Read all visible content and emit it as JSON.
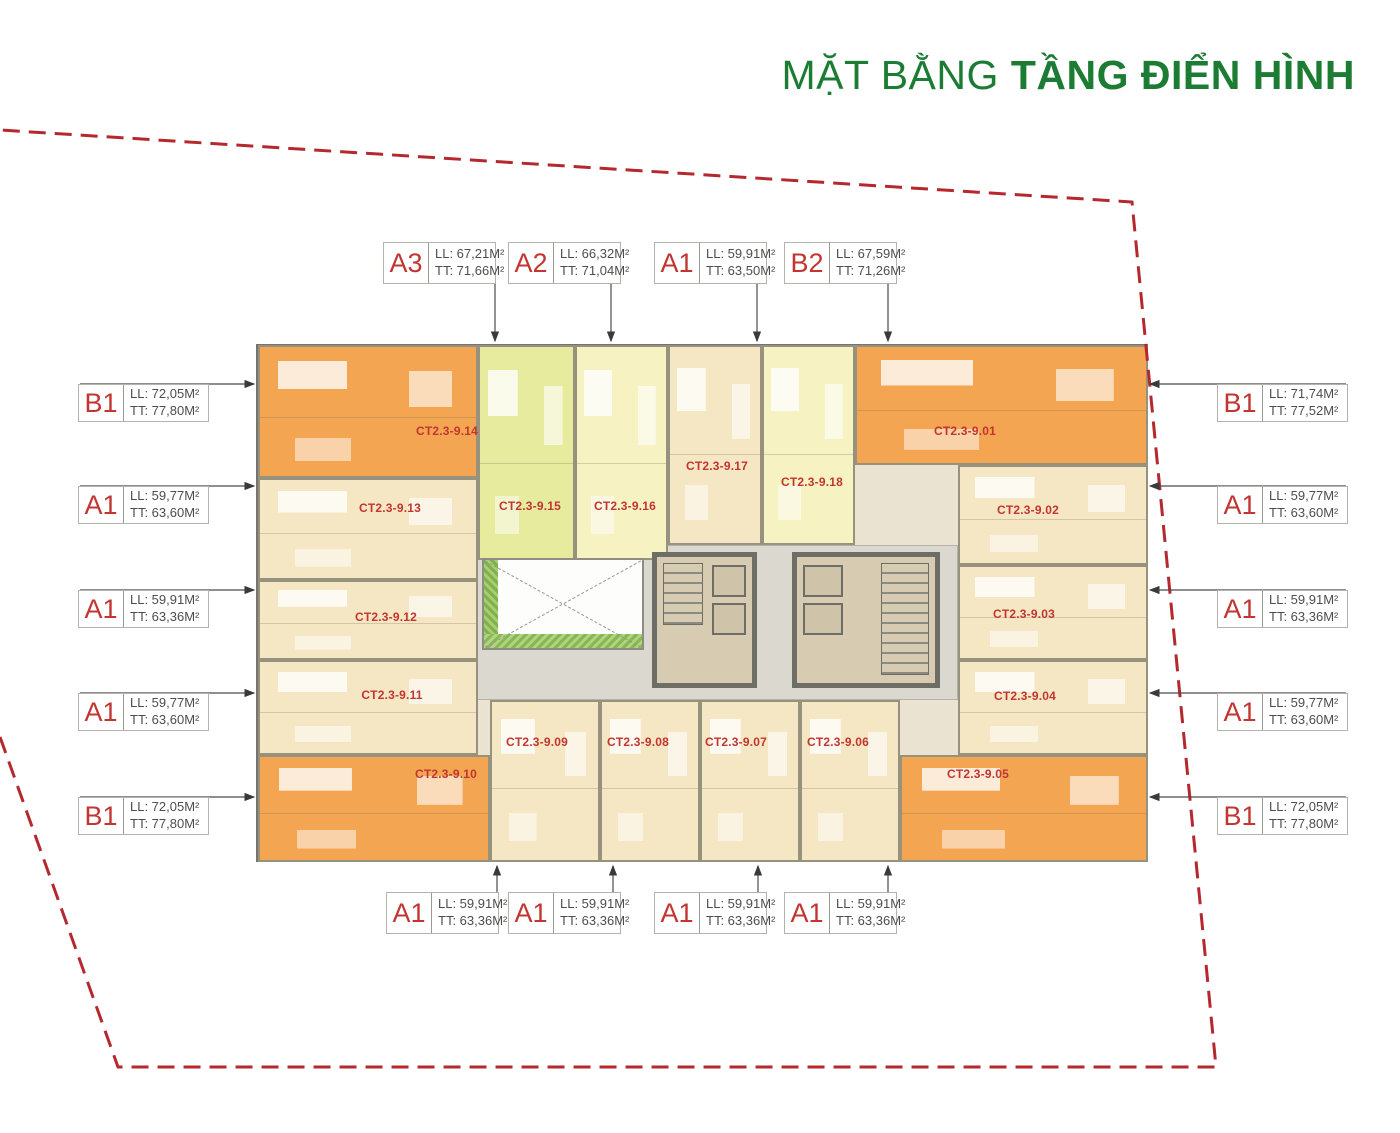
{
  "title": {
    "prefix": "MẶT BẰNG",
    "emphasis": "TẦNG ĐIỂN HÌNH"
  },
  "colors": {
    "title_green": "#1d7c34",
    "label_red": "#c23531",
    "boundary_red": "#b4282e",
    "leader_gray": "#4a4a4a",
    "unit_orange": "#f3a552",
    "unit_cream": "#f6e7c4",
    "unit_yellow_green": "#e6eb9e",
    "unit_pale_yellow": "#f6f2c2",
    "corridor_gray": "#dbd8cf"
  },
  "unit_type_labels": {
    "top": [
      {
        "code": "A3",
        "line1": "LL: 67,21M²",
        "line2": "TT: 71,66M²",
        "x": 383,
        "y": 242,
        "leader_x": 495
      },
      {
        "code": "A2",
        "line1": "LL: 66,32M²",
        "line2": "TT: 71,04M²",
        "x": 508,
        "y": 242,
        "leader_x": 611
      },
      {
        "code": "A1",
        "line1": "LL: 59,91M²",
        "line2": "TT: 63,50M²",
        "x": 654,
        "y": 242,
        "leader_x": 757
      },
      {
        "code": "B2",
        "line1": "LL: 67,59M²",
        "line2": "TT: 71,26M²",
        "x": 784,
        "y": 242,
        "leader_x": 888
      }
    ],
    "bottom": [
      {
        "code": "A1",
        "line1": "LL: 59,91M²",
        "line2": "TT: 63,36M²",
        "x": 386,
        "y": 892,
        "leader_x": 497
      },
      {
        "code": "A1",
        "line1": "LL: 59,91M²",
        "line2": "TT: 63,36M²",
        "x": 508,
        "y": 892,
        "leader_x": 613
      },
      {
        "code": "A1",
        "line1": "LL: 59,91M²",
        "line2": "TT: 63,36M²",
        "x": 654,
        "y": 892,
        "leader_x": 758
      },
      {
        "code": "A1",
        "line1": "LL: 59,91M²",
        "line2": "TT: 63,36M²",
        "x": 784,
        "y": 892,
        "leader_x": 888
      }
    ],
    "left": [
      {
        "code": "B1",
        "line1": "LL: 72,05M²",
        "line2": "TT: 77,80M²",
        "x": 78,
        "y": 384
      },
      {
        "code": "A1",
        "line1": "LL: 59,77M²",
        "line2": "TT: 63,60M²",
        "x": 78,
        "y": 486
      },
      {
        "code": "A1",
        "line1": "LL: 59,91M²",
        "line2": "TT: 63,36M²",
        "x": 78,
        "y": 590
      },
      {
        "code": "A1",
        "line1": "LL: 59,77M²",
        "line2": "TT: 63,60M²",
        "x": 78,
        "y": 693
      },
      {
        "code": "B1",
        "line1": "LL: 72,05M²",
        "line2": "TT: 77,80M²",
        "x": 78,
        "y": 797
      }
    ],
    "right": [
      {
        "code": "B1",
        "line1": "LL: 71,74M²",
        "line2": "TT: 77,52M²",
        "x": 1217,
        "y": 384
      },
      {
        "code": "A1",
        "line1": "LL: 59,77M²",
        "line2": "TT: 63,60M²",
        "x": 1217,
        "y": 486
      },
      {
        "code": "A1",
        "line1": "LL: 59,91M²",
        "line2": "TT: 63,36M²",
        "x": 1217,
        "y": 590
      },
      {
        "code": "A1",
        "line1": "LL: 59,77M²",
        "line2": "TT: 63,60M²",
        "x": 1217,
        "y": 693
      },
      {
        "code": "B1",
        "line1": "LL: 72,05M²",
        "line2": "TT: 77,80M²",
        "x": 1217,
        "y": 797
      }
    ]
  },
  "apartment_units": [
    {
      "code": "CT2.3-9.14",
      "type": "orange",
      "rect": [
        258,
        345,
        220,
        133
      ],
      "code_pos": [
        447,
        431
      ]
    },
    {
      "code": "CT2.3-9.13",
      "type": "cream",
      "rect": [
        258,
        478,
        220,
        102
      ],
      "code_pos": [
        390,
        508
      ]
    },
    {
      "code": "CT2.3-9.15",
      "type": "yellow_green",
      "rect": [
        478,
        345,
        97,
        215
      ],
      "code_pos": [
        530,
        506
      ]
    },
    {
      "code": "CT2.3-9.16",
      "type": "pale_yellow",
      "rect": [
        575,
        345,
        93,
        215
      ],
      "code_pos": [
        625,
        506
      ]
    },
    {
      "code": "CT2.3-9.17",
      "type": "cream",
      "rect": [
        668,
        345,
        94,
        200
      ],
      "code_pos": [
        717,
        466
      ]
    },
    {
      "code": "CT2.3-9.18",
      "type": "pale_yellow",
      "rect": [
        762,
        345,
        93,
        200
      ],
      "code_pos": [
        812,
        482
      ]
    },
    {
      "code": "CT2.3-9.01",
      "type": "orange",
      "rect": [
        855,
        345,
        293,
        120
      ],
      "code_pos": [
        965,
        431
      ]
    },
    {
      "code": "CT2.3-9.02",
      "type": "cream",
      "rect": [
        958,
        465,
        190,
        100
      ],
      "code_pos": [
        1028,
        510
      ]
    },
    {
      "code": "CT2.3-9.03",
      "type": "cream",
      "rect": [
        958,
        565,
        190,
        95
      ],
      "code_pos": [
        1024,
        614
      ]
    },
    {
      "code": "CT2.3-9.04",
      "type": "cream",
      "rect": [
        958,
        660,
        190,
        95
      ],
      "code_pos": [
        1025,
        696
      ]
    },
    {
      "code": "CT2.3-9.05",
      "type": "orange",
      "rect": [
        900,
        755,
        248,
        107
      ],
      "code_pos": [
        978,
        774
      ]
    },
    {
      "code": "CT2.3-9.06",
      "type": "cream",
      "rect": [
        800,
        700,
        100,
        162
      ],
      "code_pos": [
        838,
        742
      ]
    },
    {
      "code": "CT2.3-9.07",
      "type": "cream",
      "rect": [
        700,
        700,
        100,
        162
      ],
      "code_pos": [
        736,
        742
      ]
    },
    {
      "code": "CT2.3-9.08",
      "type": "cream",
      "rect": [
        600,
        700,
        100,
        162
      ],
      "code_pos": [
        638,
        742
      ]
    },
    {
      "code": "CT2.3-9.09",
      "type": "cream",
      "rect": [
        490,
        700,
        110,
        162
      ],
      "code_pos": [
        537,
        742
      ]
    },
    {
      "code": "CT2.3-9.10",
      "type": "orange",
      "rect": [
        258,
        755,
        232,
        107
      ],
      "code_pos": [
        446,
        774
      ]
    },
    {
      "code": "CT2.3-9.11",
      "type": "cream",
      "rect": [
        258,
        660,
        220,
        95
      ],
      "code_pos": [
        392,
        695
      ]
    },
    {
      "code": "CT2.3-9.12",
      "type": "cream",
      "rect": [
        258,
        580,
        220,
        80
      ],
      "code_pos": [
        386,
        617
      ]
    }
  ],
  "boundary": {
    "points": [
      [
        0,
        737
      ],
      [
        118,
        1067
      ],
      [
        1216,
        1067
      ],
      [
        1132,
        202
      ],
      [
        0,
        130
      ]
    ],
    "dash": "17 9"
  },
  "building_edges": {
    "top": 341,
    "bottom": 866,
    "left": 254,
    "right": 1150
  }
}
